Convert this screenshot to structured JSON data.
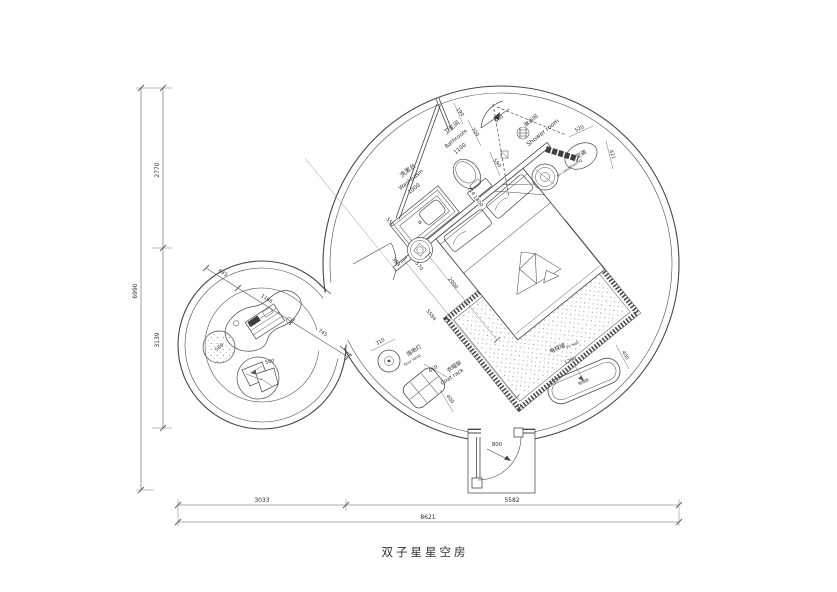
{
  "title": "双子星星空房",
  "labels": {
    "washbasin_cn": "洗漱台",
    "washbasin_en": "Washbasin",
    "bathroom_cn": "卫生间",
    "bathroom_en": "Bathroom",
    "shower_cn": "淋浴间",
    "shower_en": "Shower room",
    "ac_cn": "空调",
    "ac_en": "air conditioning",
    "floor_lamp_cn": "落地灯",
    "floor_lamp_en": "floor lamp",
    "coat_rack_cn": "衣帽架",
    "coat_rack_en": "Coat rack",
    "tv_wall_cn": "电视墙",
    "tv_wall_en": "TV wall",
    "tv_cabinet_cn": "电视柜"
  },
  "dims": {
    "d190": "190",
    "d700": "700",
    "d500_shower": "500",
    "d590": "590",
    "d550": "550",
    "d1000": "1000",
    "d1100": "1100",
    "d714": "714",
    "d1800": "1800",
    "d520": "520",
    "d421": "421",
    "d383": "383",
    "d570": "570",
    "d2000": "2000",
    "d5584": "5584",
    "d310": "310",
    "d660": "660",
    "d400_coat": "400",
    "d1200": "1200",
    "d400_tv": "400",
    "d800": "800",
    "d693": "693",
    "d1166": "1166",
    "d745": "745",
    "d589": "589",
    "d500_cushion": "500",
    "d2770": "2770",
    "d3139": "3139",
    "d6990": "6990",
    "d3033": "3033",
    "d5582": "5582",
    "d8621": "8621"
  },
  "colors": {
    "ink": "#454545",
    "dark_fill": "#3d3d3d"
  }
}
